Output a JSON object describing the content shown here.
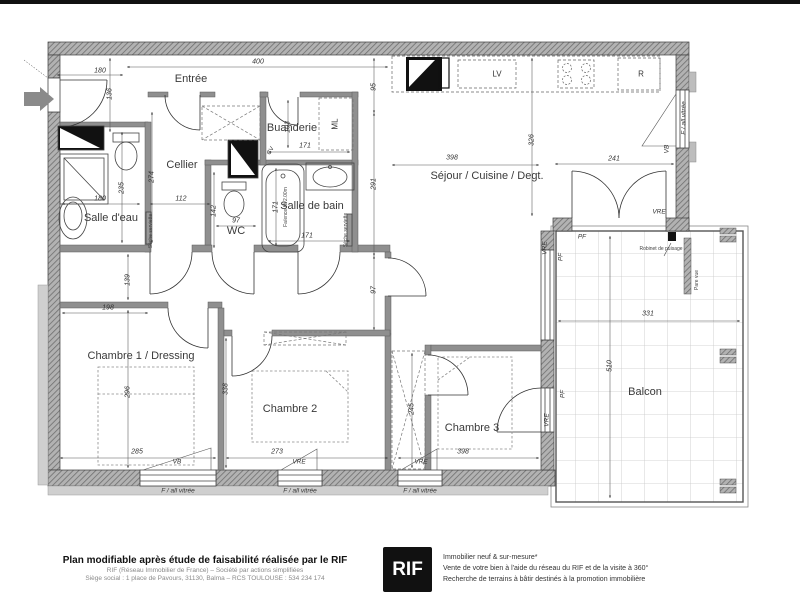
{
  "plan": {
    "rooms": [
      {
        "name": "Entrée",
        "x": 191,
        "y": 79
      },
      {
        "name": "Cellier",
        "x": 182,
        "y": 165
      },
      {
        "name": "Salle d'eau",
        "x": 111,
        "y": 218
      },
      {
        "name": "WC",
        "x": 236,
        "y": 231
      },
      {
        "name": "Salle de bain",
        "x": 312,
        "y": 206
      },
      {
        "name": "Buanderie",
        "x": 292,
        "y": 128
      },
      {
        "name": "Séjour / Cuisine / Degt.",
        "x": 487,
        "y": 176
      },
      {
        "name": "Chambre 1 / Dressing",
        "x": 141,
        "y": 356
      },
      {
        "name": "Chambre 2",
        "x": 290,
        "y": 409
      },
      {
        "name": "Chambre 3",
        "x": 472,
        "y": 428
      },
      {
        "name": "Balcon",
        "x": 645,
        "y": 392
      }
    ],
    "dimensions": [
      {
        "value": "180",
        "x": 100,
        "y": 71
      },
      {
        "value": "400",
        "x": 258,
        "y": 62
      },
      {
        "value": "136",
        "x": 110,
        "y": 94,
        "rot": -90
      },
      {
        "value": "274",
        "x": 152,
        "y": 177,
        "rot": -90
      },
      {
        "value": "235",
        "x": 122,
        "y": 188,
        "rot": -90
      },
      {
        "value": "180",
        "x": 100,
        "y": 199
      },
      {
        "value": "112",
        "x": 181,
        "y": 199
      },
      {
        "value": "142",
        "x": 214,
        "y": 211,
        "rot": -90
      },
      {
        "value": "97",
        "x": 236,
        "y": 221
      },
      {
        "value": "171",
        "x": 276,
        "y": 207,
        "rot": -90
      },
      {
        "value": "171",
        "x": 307,
        "y": 236
      },
      {
        "value": "171",
        "x": 305,
        "y": 146
      },
      {
        "value": "103",
        "x": 288,
        "y": 127,
        "rot": -90
      },
      {
        "value": "95",
        "x": 374,
        "y": 87,
        "rot": -90
      },
      {
        "value": "291",
        "x": 374,
        "y": 184,
        "rot": -90
      },
      {
        "value": "97",
        "x": 374,
        "y": 290,
        "rot": -90
      },
      {
        "value": "398",
        "x": 452,
        "y": 158
      },
      {
        "value": "326",
        "x": 532,
        "y": 140,
        "rot": -90
      },
      {
        "value": "241",
        "x": 614,
        "y": 159
      },
      {
        "value": "198",
        "x": 108,
        "y": 308
      },
      {
        "value": "139",
        "x": 128,
        "y": 280,
        "rot": -90
      },
      {
        "value": "296",
        "x": 128,
        "y": 392,
        "rot": -90
      },
      {
        "value": "338",
        "x": 226,
        "y": 389,
        "rot": -90
      },
      {
        "value": "245",
        "x": 412,
        "y": 409,
        "rot": -90
      },
      {
        "value": "285",
        "x": 137,
        "y": 452
      },
      {
        "value": "273",
        "x": 277,
        "y": 452
      },
      {
        "value": "398",
        "x": 463,
        "y": 452
      },
      {
        "value": "331",
        "x": 648,
        "y": 314
      },
      {
        "value": "510",
        "x": 610,
        "y": 366,
        "rot": -90
      }
    ],
    "openings": [
      {
        "label": "VB",
        "x": 177,
        "y": 462
      },
      {
        "label": "VRE",
        "x": 299,
        "y": 462
      },
      {
        "label": "VRE",
        "x": 421,
        "y": 462
      },
      {
        "label": "F / all vitrée",
        "x": 178,
        "y": 491
      },
      {
        "label": "F / all vitrée",
        "x": 300,
        "y": 491
      },
      {
        "label": "F / all vitrée",
        "x": 420,
        "y": 491
      },
      {
        "label": "VB",
        "x": 667,
        "y": 149,
        "rot": -90
      },
      {
        "label": "F / all vitrée",
        "x": 684,
        "y": 118,
        "rot": -90
      },
      {
        "label": "VRE",
        "x": 659,
        "y": 212
      },
      {
        "label": "PF",
        "x": 582,
        "y": 237
      },
      {
        "label": "PF",
        "x": 561,
        "y": 257,
        "rot": -90
      },
      {
        "label": "VRE",
        "x": 545,
        "y": 248,
        "rot": -90
      },
      {
        "label": "PF",
        "x": 563,
        "y": 394,
        "rot": -90
      },
      {
        "label": "VRE",
        "x": 547,
        "y": 420,
        "rot": -90
      }
    ],
    "appliances": [
      {
        "label": "LV",
        "x": 497,
        "y": 74
      },
      {
        "label": "R",
        "x": 641,
        "y": 74
      },
      {
        "label": "ML",
        "x": 335,
        "y": 124,
        "rot": -90
      },
      {
        "label": "CV",
        "x": 271,
        "y": 151,
        "rot": -60,
        "s": 6
      }
    ],
    "notes": [
      {
        "text": "Robinet de puisage",
        "x": 661,
        "y": 249
      },
      {
        "text": "Pare vue",
        "x": 697,
        "y": 280,
        "rot": -90
      },
      {
        "text": "Faïence Ht 2.00m",
        "x": 286,
        "y": 207,
        "rot": -90
      },
      {
        "text": "Sèche serviette",
        "x": 151,
        "y": 231,
        "rot": -90
      },
      {
        "text": "Sèche serviette",
        "x": 346,
        "y": 230,
        "rot": -90
      }
    ]
  },
  "footer": {
    "headline": "Plan modifiable après étude de faisabilité réalisée par le RIF",
    "company": "RIF (Réseau Immobilier de France) – Société par actions simplifiées",
    "address": "Siège social : 1 place de Pavours, 31130, Balma – RCS TOULOUSE : 534 234 174",
    "logo": "RIF",
    "services": [
      "Immobilier neuf & sur-mesure*",
      "Vente de votre bien à l'aide du réseau du RIF et de la visite à 360°",
      "Recherche de terrains à bâtir destinés à la promotion immobilière"
    ]
  }
}
